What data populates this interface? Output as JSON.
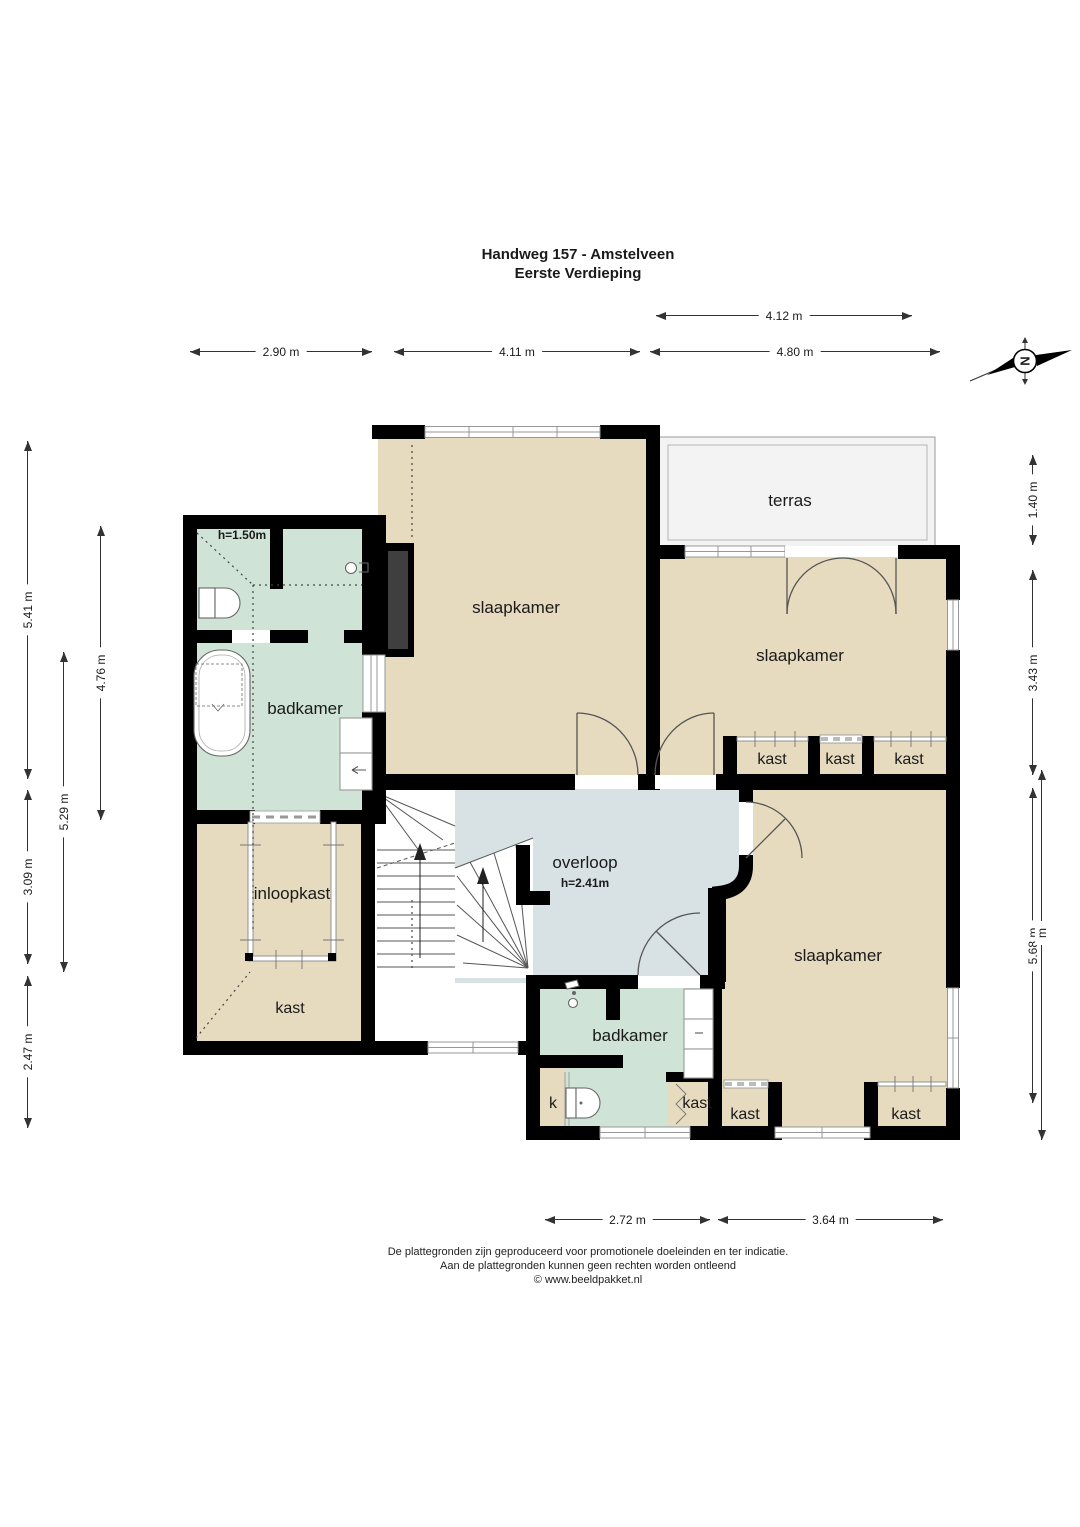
{
  "title": {
    "line1": "Handweg 157 - Amstelveen",
    "line2": "Eerste Verdieping"
  },
  "compass": {
    "north_letter": "N"
  },
  "rooms": {
    "slaapkamer_top": "slaapkamer",
    "slaapkamer_right": "slaapkamer",
    "slaapkamer_bottom": "slaapkamer",
    "badkamer_top": "badkamer",
    "badkamer_top_height": "h=1.50m",
    "badkamer_bottom": "badkamer",
    "terras": "terras",
    "overloop": "overloop",
    "overloop_height": "h=2.41m",
    "inloopkast": "inloopkast",
    "kast_left": "kast",
    "kast_top_1": "kast",
    "kast_top_2": "kast",
    "kast_top_3": "kast",
    "kast_bottom_left": "kast",
    "kast_bottom_right": "kast",
    "kast_badkamer": "kast",
    "k_closet": "k"
  },
  "dimensions": {
    "d412": "4.12 m",
    "d290": "2.90 m",
    "d411": "4.11 m",
    "d480": "4.80 m",
    "d541": "5.41 m",
    "d309": "3.09 m",
    "d247": "2.47 m",
    "d529": "5.29 m",
    "d476": "4.76 m",
    "d140": "1.40 m",
    "d343": "3.43 m",
    "d568": "5.68 m",
    "d568b": "m",
    "d272": "2.72 m",
    "d364": "3.64 m"
  },
  "footer": {
    "line1": "De plattegronden zijn geproduceerd voor promotionele doeleinden en ter indicatie.",
    "line2": "Aan de plattegronden kunnen geen rechten worden ontleend",
    "line3": "© www.beeldpakket.nl"
  },
  "colors": {
    "wall": "#000000",
    "room_beige": "#e6dabf",
    "room_mint": "#cfe3d7",
    "room_landing": "#d8e1e3",
    "terras": "#f3f3f3",
    "flue": "#3f3f3f"
  }
}
